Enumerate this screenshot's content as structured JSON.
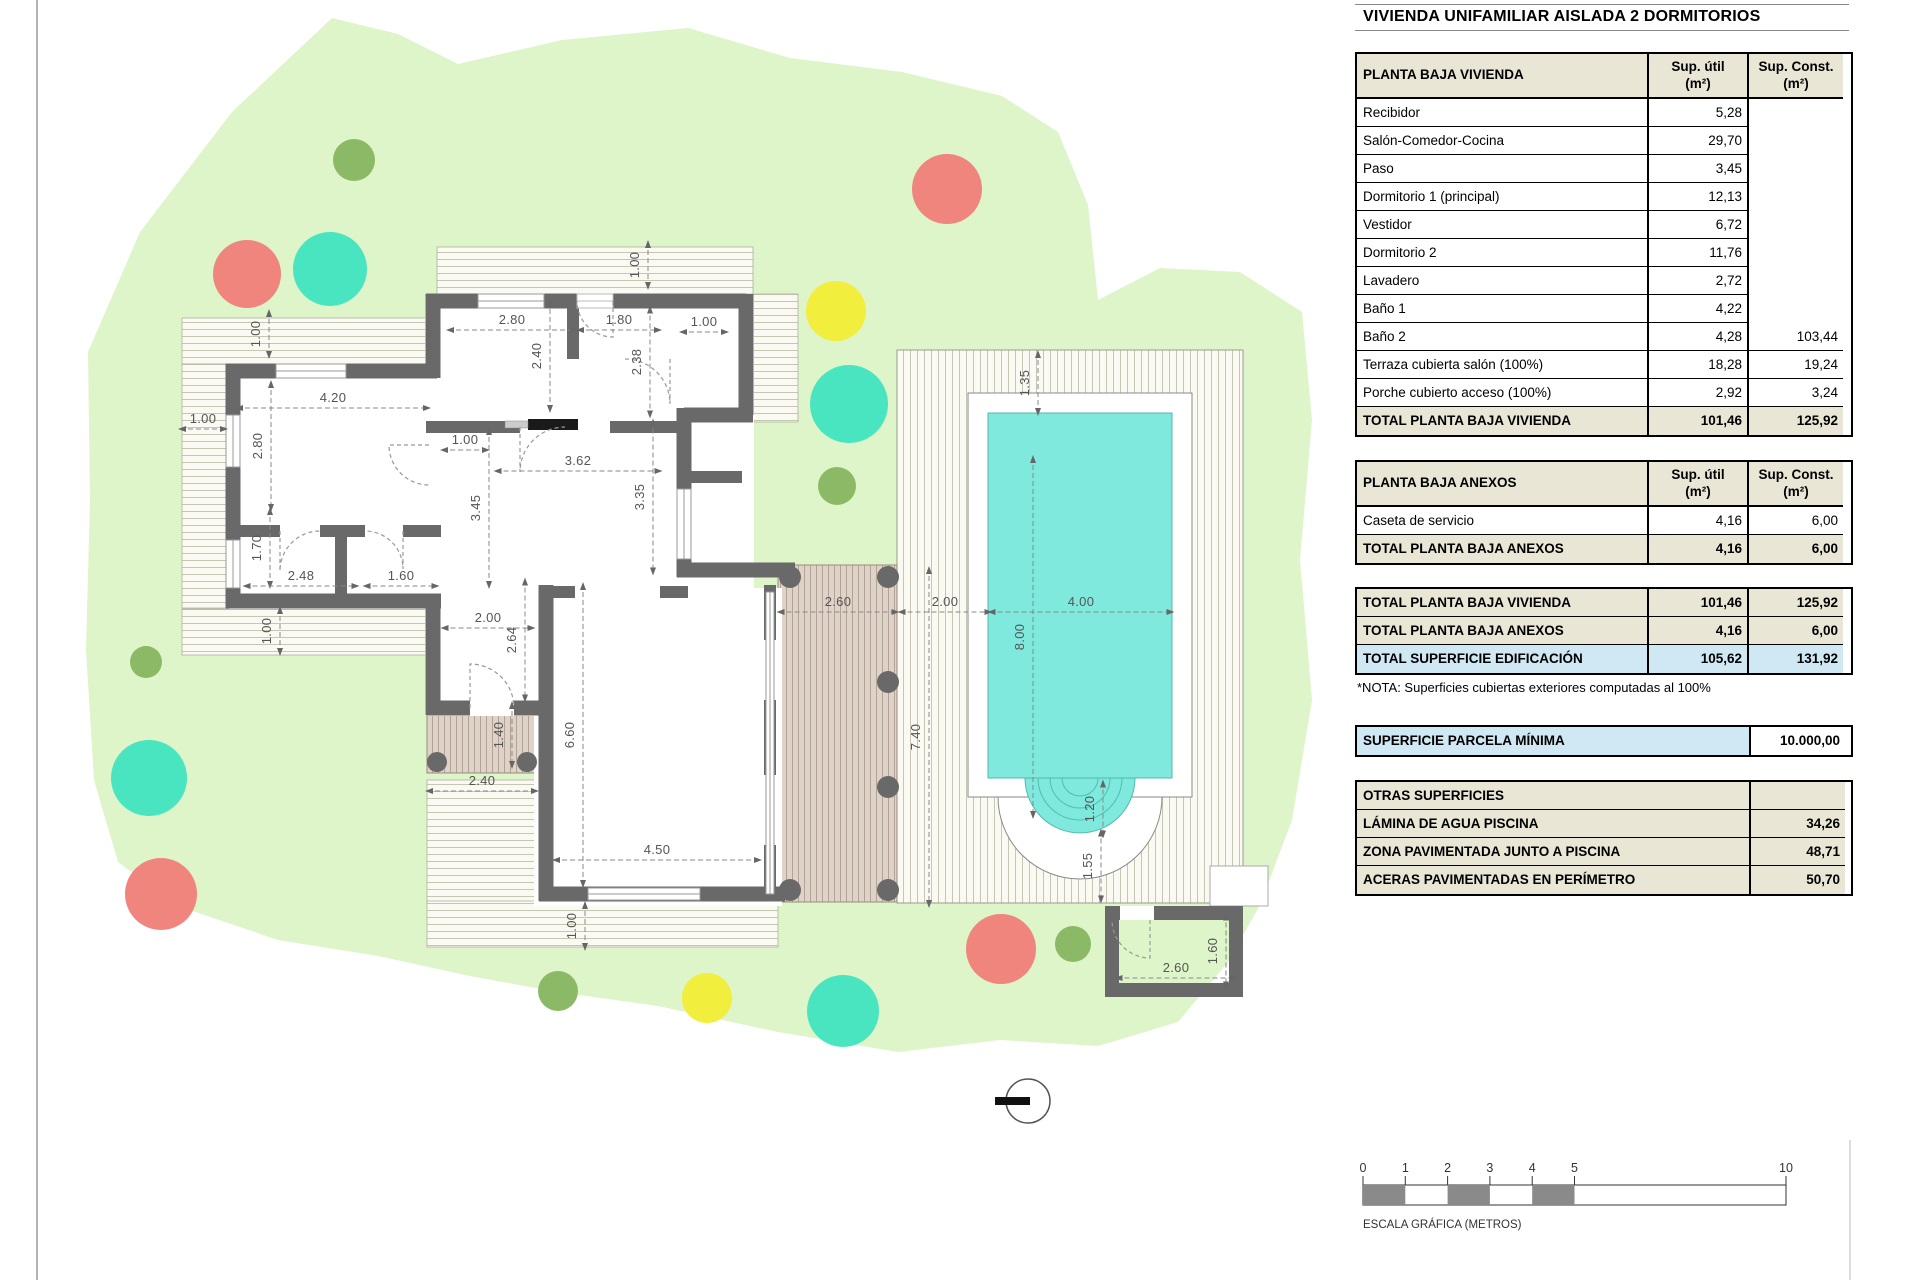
{
  "title": "VIVIENDA UNIFAMILIAR AISLADA 2 DORMITORIOS",
  "colors": {
    "parcel_green": "#ddf5c8",
    "wall_gray": "#696969",
    "pool_cyan": "#7fe9dd",
    "beige_header": "#e9e6d6",
    "blue_highlight": "#cfe8f4",
    "tree_red": "#f0857d",
    "tree_teal": "#49e5c0",
    "tree_yellow": "#f1ee3d",
    "tree_olive": "#8cb966"
  },
  "tables": {
    "vivienda": {
      "header": {
        "name": "PLANTA BAJA VIVIENDA",
        "util": "Sup. útil\n(m²)",
        "konst": "Sup. Const.\n(m²)"
      },
      "rows": [
        [
          "Recibidor",
          "5,28",
          ""
        ],
        [
          "Salón-Comedor-Cocina",
          "29,70",
          ""
        ],
        [
          "Paso",
          "3,45",
          ""
        ],
        [
          "Dormitorio 1 (principal)",
          "12,13",
          ""
        ],
        [
          "Vestidor",
          "6,72",
          ""
        ],
        [
          "Dormitorio 2",
          "11,76",
          ""
        ],
        [
          "Lavadero",
          "2,72",
          ""
        ],
        [
          "Baño 1",
          "4,22",
          ""
        ],
        [
          "Baño 2",
          "4,28",
          "103,44"
        ],
        [
          "Terraza cubierta salón (100%)",
          "18,28",
          "19,24"
        ],
        [
          "Porche cubierto acceso (100%)",
          "2,92",
          "3,24"
        ]
      ],
      "total": [
        "TOTAL PLANTA BAJA VIVIENDA",
        "101,46",
        "125,92"
      ]
    },
    "anexos": {
      "header": {
        "name": "PLANTA BAJA ANEXOS",
        "util": "Sup. útil\n(m²)",
        "konst": "Sup. Const.\n(m²)"
      },
      "rows": [
        [
          "Caseta de servicio",
          "4,16",
          "6,00"
        ]
      ],
      "total": [
        "TOTAL PLANTA BAJA ANEXOS",
        "4,16",
        "6,00"
      ]
    },
    "summary": [
      {
        "label": "TOTAL PLANTA BAJA VIVIENDA",
        "util": "101,46",
        "konst": "125,92",
        "style": "beige"
      },
      {
        "label": "TOTAL PLANTA BAJA ANEXOS",
        "util": "4,16",
        "konst": "6,00",
        "style": "beige"
      },
      {
        "label": "TOTAL SUPERFICIE EDIFICACIÓN",
        "util": "105,62",
        "konst": "131,92",
        "style": "blue"
      }
    ],
    "nota": "*NOTA: Superficies cubiertas exteriores computadas al 100%",
    "parcela": {
      "label": "SUPERFICIE PARCELA MÍNIMA",
      "value": "10.000,00"
    },
    "otras": {
      "header": "OTRAS SUPERFICIES",
      "rows": [
        [
          "LÁMINA DE AGUA PISCINA",
          "34,26"
        ],
        [
          "ZONA PAVIMENTADA JUNTO A PISCINA",
          "48,71"
        ],
        [
          "ACERAS PAVIMENTADAS EN PERÍMETRO",
          "50,70"
        ]
      ]
    }
  },
  "plan": {
    "dimensions": [
      {
        "t": "1.00",
        "x": 256,
        "y": 334,
        "r": 90,
        "l": 46
      },
      {
        "t": "1.00",
        "x": 203,
        "y": 419,
        "r": 0,
        "l": 46
      },
      {
        "t": "4.20",
        "x": 333,
        "y": 398,
        "r": 0,
        "l": 192
      },
      {
        "t": "2.80",
        "x": 258,
        "y": 446,
        "r": 90,
        "l": 128
      },
      {
        "t": "1.70",
        "x": 257,
        "y": 548,
        "r": 90,
        "l": 78
      },
      {
        "t": "2.48",
        "x": 301,
        "y": 576,
        "r": 0,
        "l": 113
      },
      {
        "t": "1.60",
        "x": 401,
        "y": 576,
        "r": 0,
        "l": 73
      },
      {
        "t": "1.00",
        "x": 267,
        "y": 631,
        "r": 90,
        "l": 46
      },
      {
        "t": "2.80",
        "x": 512,
        "y": 320,
        "r": 0,
        "l": 128
      },
      {
        "t": "1.80",
        "x": 619,
        "y": 320,
        "r": 0,
        "l": 82
      },
      {
        "t": "1.00",
        "x": 704,
        "y": 322,
        "r": 0,
        "l": 46
      },
      {
        "t": "1.00",
        "x": 635,
        "y": 265,
        "r": 90,
        "l": 46
      },
      {
        "t": "2.40",
        "x": 537,
        "y": 356,
        "r": 90,
        "l": 110
      },
      {
        "t": "2.38",
        "x": 637,
        "y": 362,
        "r": 90,
        "l": 109
      },
      {
        "t": "1.00",
        "x": 465,
        "y": 440,
        "r": 0,
        "l": 46
      },
      {
        "t": "3.62",
        "x": 578,
        "y": 461,
        "r": 0,
        "l": 165
      },
      {
        "t": "3.45",
        "x": 476,
        "y": 508,
        "r": 90,
        "l": 158
      },
      {
        "t": "3.35",
        "x": 640,
        "y": 497,
        "r": 90,
        "l": 153
      },
      {
        "t": "2.00",
        "x": 488,
        "y": 618,
        "r": 0,
        "l": 91
      },
      {
        "t": "2.64",
        "x": 512,
        "y": 640,
        "r": 90,
        "l": 121
      },
      {
        "t": "1.40",
        "x": 499,
        "y": 735,
        "r": 90,
        "l": 64
      },
      {
        "t": "2.40",
        "x": 482,
        "y": 781,
        "r": 0,
        "l": 110
      },
      {
        "t": "6.60",
        "x": 570,
        "y": 735,
        "r": 90,
        "l": 302
      },
      {
        "t": "4.50",
        "x": 657,
        "y": 850,
        "r": 0,
        "l": 206
      },
      {
        "t": "1.00",
        "x": 572,
        "y": 926,
        "r": 90,
        "l": 46
      },
      {
        "t": "2.60",
        "x": 838,
        "y": 602,
        "r": 0,
        "l": 119
      },
      {
        "t": "2.00",
        "x": 945,
        "y": 602,
        "r": 0,
        "l": 91
      },
      {
        "t": "4.00",
        "x": 1081,
        "y": 602,
        "r": 0,
        "l": 183
      },
      {
        "t": "1.35",
        "x": 1025,
        "y": 383,
        "r": 90,
        "l": 62
      },
      {
        "t": "8.00",
        "x": 1020,
        "y": 637,
        "r": 90,
        "l": 360
      },
      {
        "t": "7.40",
        "x": 916,
        "y": 737,
        "r": 90,
        "l": 338
      },
      {
        "t": "1.20",
        "x": 1090,
        "y": 809,
        "r": 90,
        "l": 55
      },
      {
        "t": "1.55",
        "x": 1088,
        "y": 866,
        "r": 90,
        "l": 71
      },
      {
        "t": "2.60",
        "x": 1176,
        "y": 968,
        "r": 0,
        "l": 119
      },
      {
        "t": "1.60",
        "x": 1213,
        "y": 951,
        "r": 90,
        "l": 73
      }
    ],
    "trees": [
      {
        "x": 354,
        "y": 160,
        "rad": 21,
        "c": "tree_olive"
      },
      {
        "x": 947,
        "y": 189,
        "rad": 35,
        "c": "tree_red"
      },
      {
        "x": 247,
        "y": 274,
        "rad": 34,
        "c": "tree_red"
      },
      {
        "x": 330,
        "y": 269,
        "rad": 37,
        "c": "tree_teal"
      },
      {
        "x": 836,
        "y": 311,
        "rad": 30,
        "c": "tree_yellow"
      },
      {
        "x": 849,
        "y": 404,
        "rad": 39,
        "c": "tree_teal"
      },
      {
        "x": 837,
        "y": 486,
        "rad": 19,
        "c": "tree_olive"
      },
      {
        "x": 146,
        "y": 662,
        "rad": 16,
        "c": "tree_olive"
      },
      {
        "x": 149,
        "y": 778,
        "rad": 38,
        "c": "tree_teal"
      },
      {
        "x": 161,
        "y": 894,
        "rad": 36,
        "c": "tree_red"
      },
      {
        "x": 558,
        "y": 991,
        "rad": 20,
        "c": "tree_olive"
      },
      {
        "x": 707,
        "y": 998,
        "rad": 25,
        "c": "tree_yellow"
      },
      {
        "x": 843,
        "y": 1011,
        "rad": 36,
        "c": "tree_teal"
      },
      {
        "x": 1001,
        "y": 949,
        "rad": 35,
        "c": "tree_red"
      },
      {
        "x": 1073,
        "y": 944,
        "rad": 18,
        "c": "tree_olive"
      }
    ]
  },
  "scalebar": {
    "ticks": [
      "0",
      "1",
      "2",
      "3",
      "4",
      "5",
      "10"
    ],
    "filled_segments": [
      [
        0,
        1
      ],
      [
        2,
        3
      ],
      [
        4,
        5
      ]
    ],
    "caption": "ESCALA GRÁFICA (METROS)"
  }
}
